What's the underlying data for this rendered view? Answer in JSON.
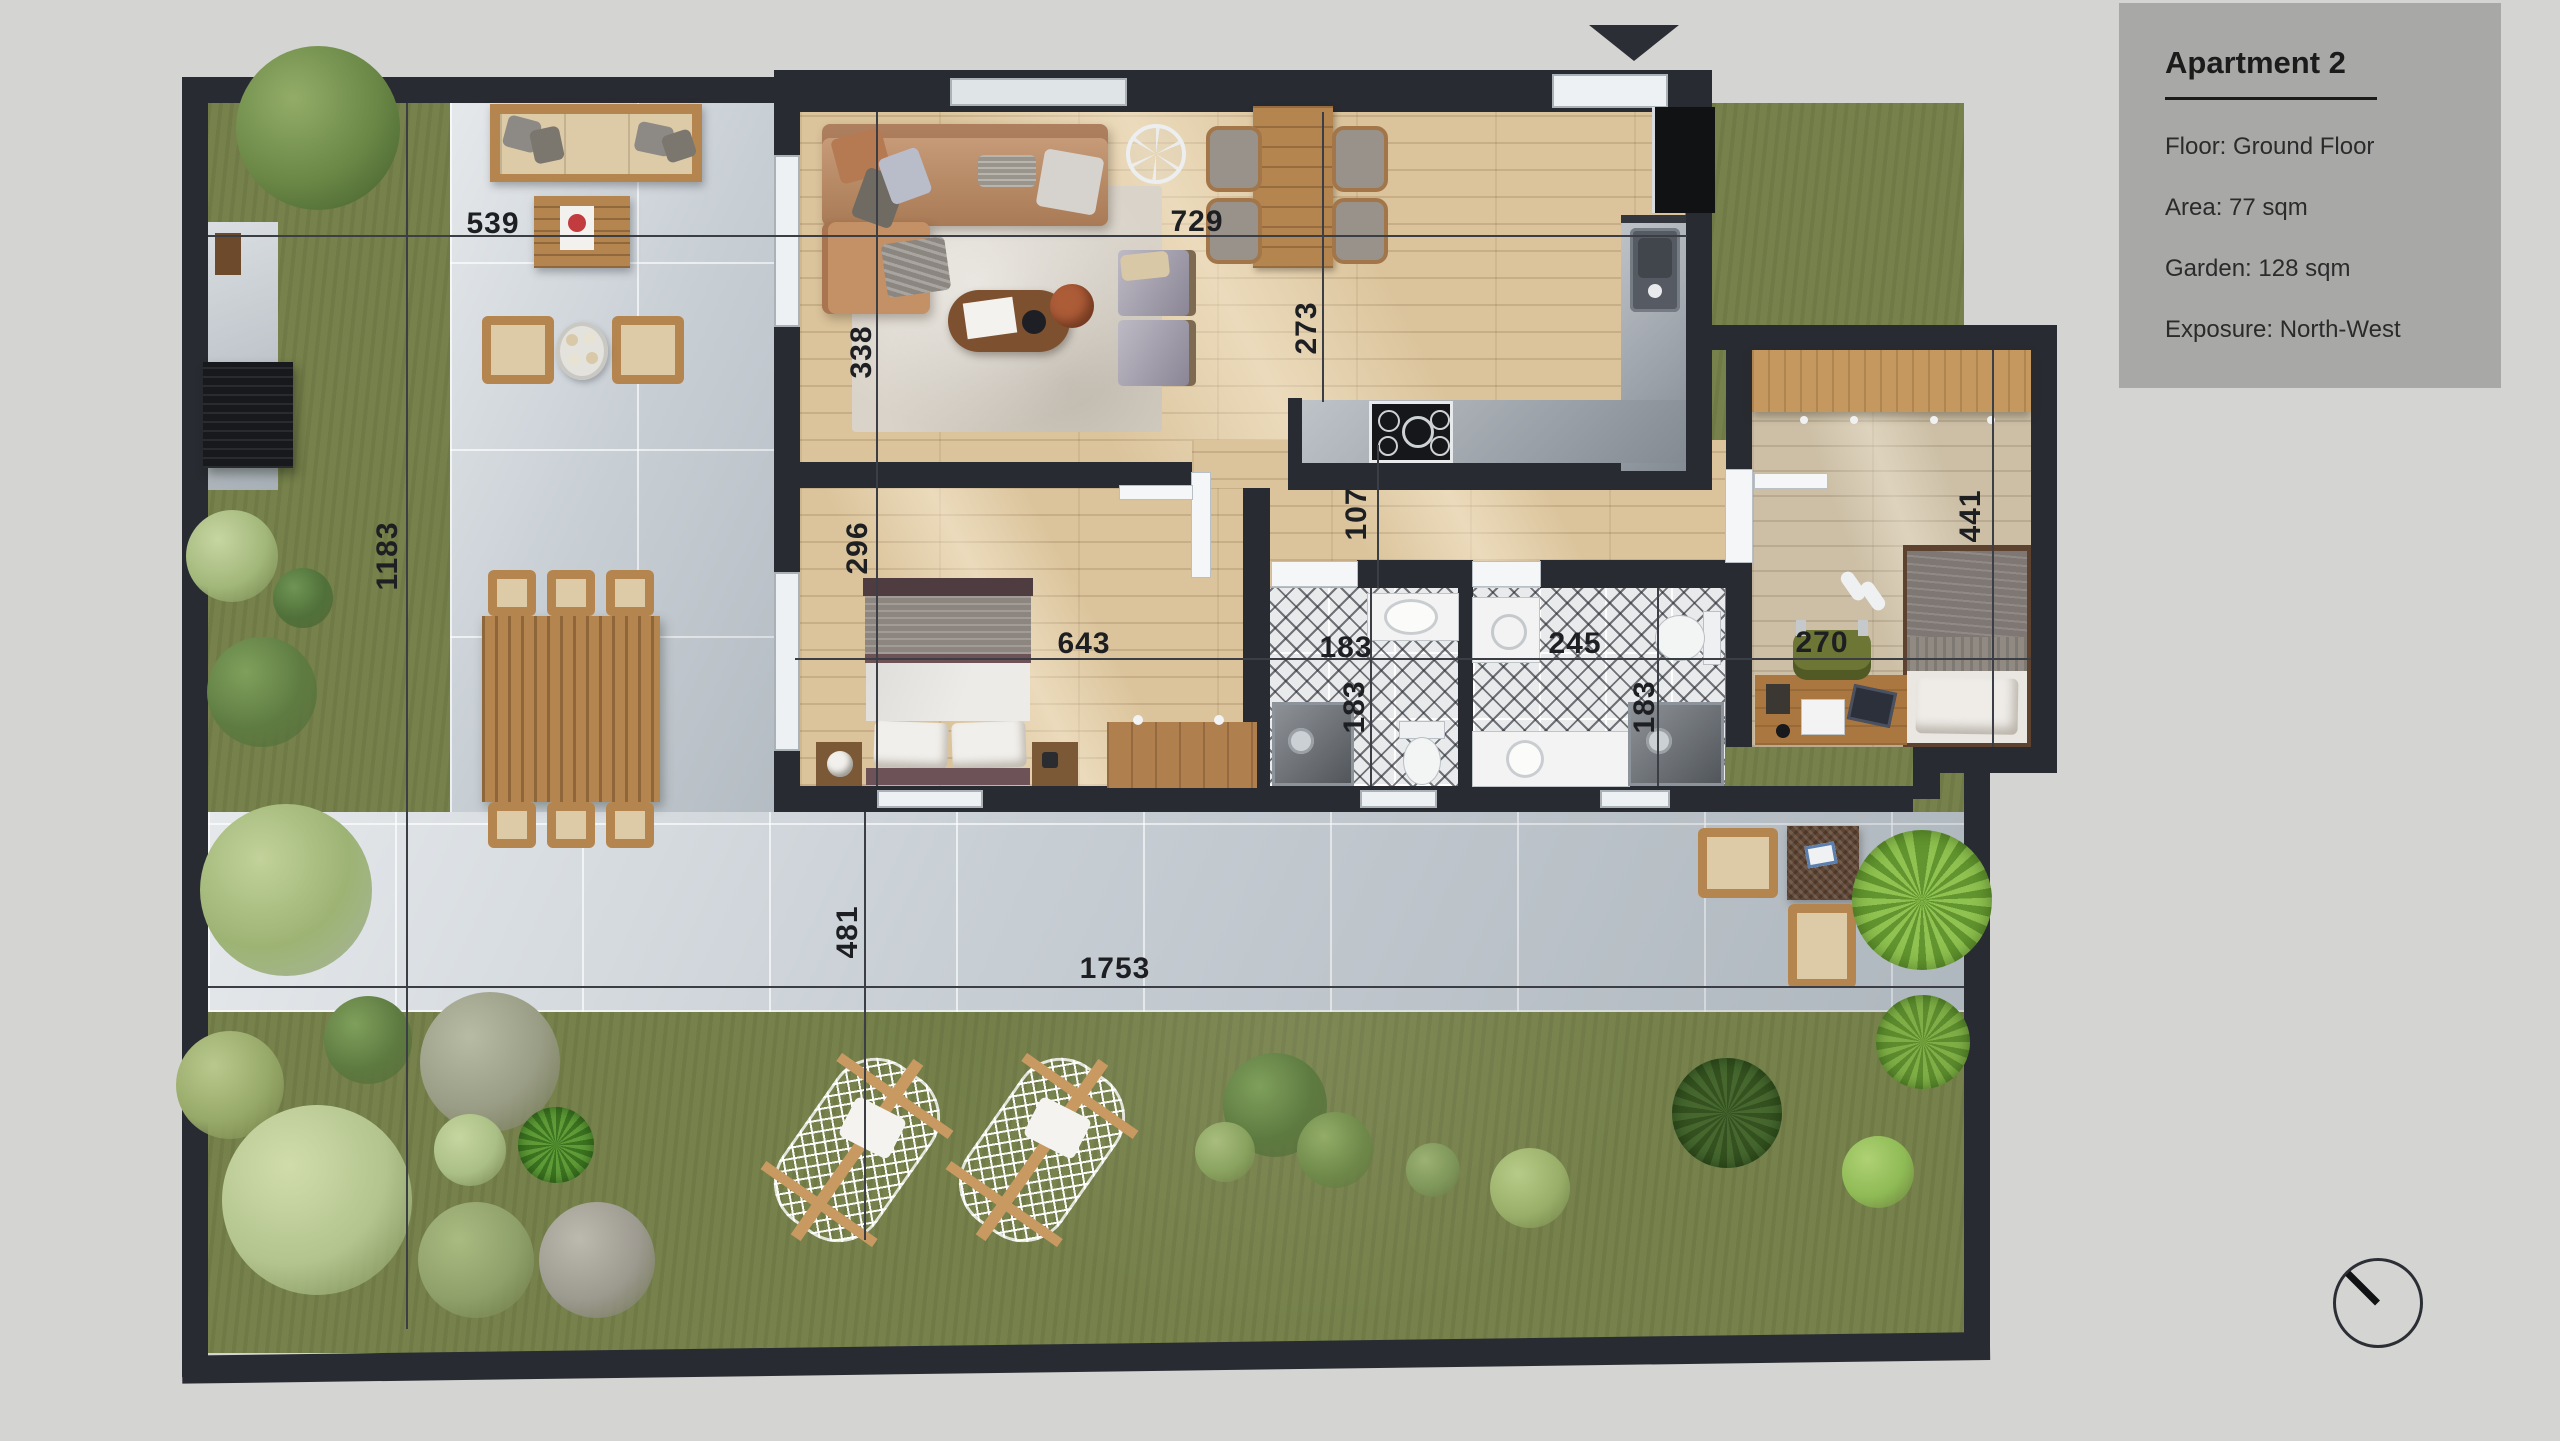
{
  "info_panel": {
    "title": "Apartment 2",
    "rows": [
      "Floor: Ground Floor",
      "Area: 77 sqm",
      "Garden: 128 sqm",
      "Exposure: North-West"
    ]
  },
  "dimensions": {
    "terrace_top_width": "539",
    "living_width": "729",
    "living_height": "338",
    "kitchen_height": "273",
    "hall_height": "107",
    "bedroom1_height": "296",
    "bedroom1_width": "643",
    "bath1_width": "183",
    "bath1_height": "183",
    "bath2_width": "245",
    "bath2_height": "183",
    "bedroom2_width": "270",
    "bedroom2_height": "441",
    "garden_left_height": "1183",
    "terrace_bottom_height": "481",
    "terrace_bottom_width": "1753"
  },
  "icons": {
    "north_arrow": "triangle-down",
    "compass": "needle-to-north-west",
    "ceiling_fan": "fan"
  }
}
